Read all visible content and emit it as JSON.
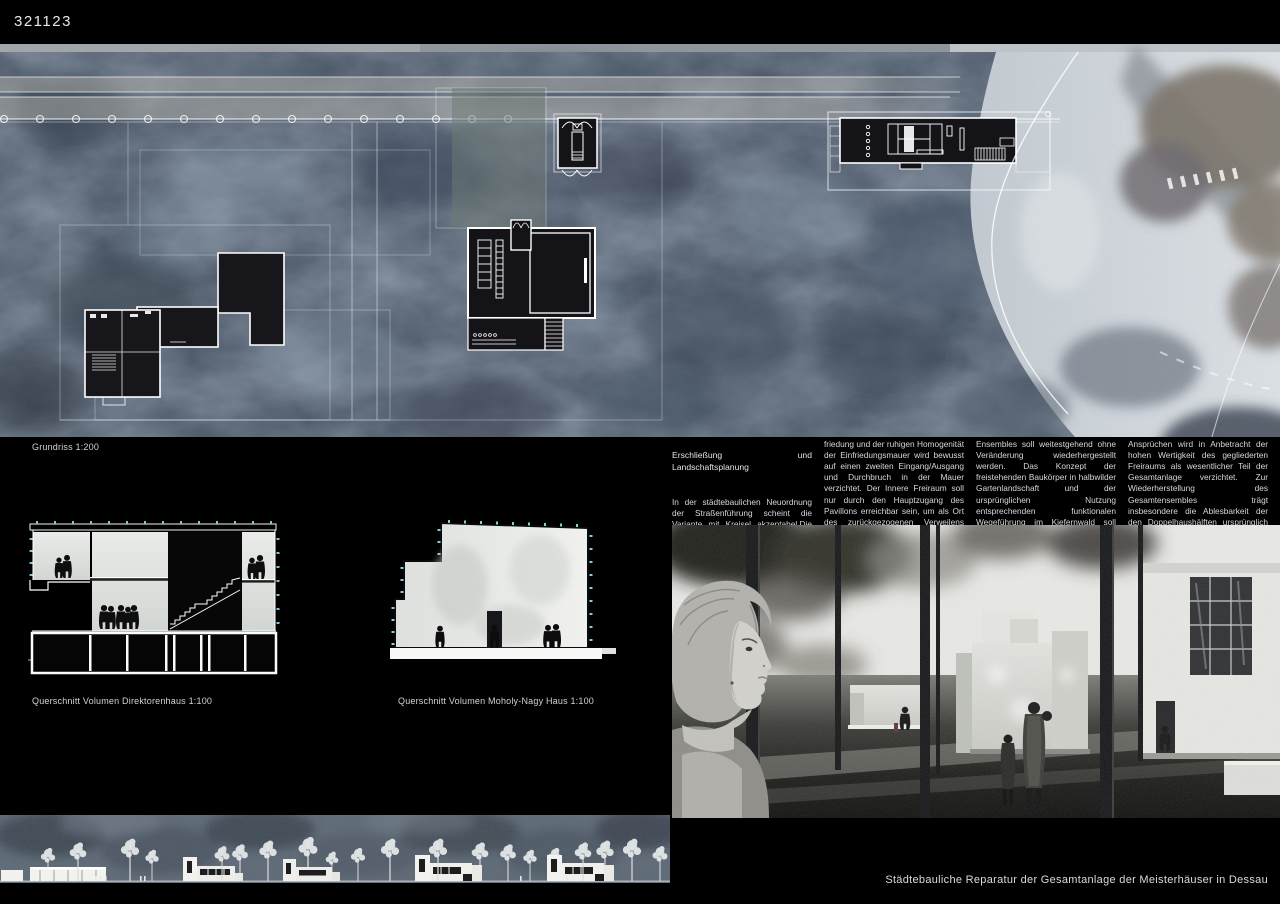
{
  "panel": {
    "code": "321123",
    "caption": "Städtebauliche Reparatur der Gesamtanlage der Meisterhäuser in Dessau"
  },
  "site_plan": {
    "label": "Grundriss 1:200"
  },
  "sections": [
    {
      "label": "Querschnitt Volumen Direktorenhaus 1:100"
    },
    {
      "label": "Querschnitt Volumen Moholy-Nagy Haus 1:100"
    }
  ],
  "description": {
    "heading": "Erschließung und Landschaftsplanung",
    "columns": [
      "In der städtebaulichen Neuordnung der Straßenführung scheint die Variante mit Kreisel akzeptabel.Die fußläufige Erschließung erfolgt von der Gropiusallee oder der Ziebigker Straße kommend über die Ebertallee zum Pavillon. Zugunsten des beruhigten Freiraumes hinter der Grundstücksein-",
      "friedung und der ruhigen Homogenität der Einfriedungsmauer wird bewusst auf einen zweiten Eingang/Ausgang und Durchbruch in der Mauer verzichtet. Der Innere Freiraum soll nur durch den Hauptzugang des Pavillons erreichbar sein, um als Ort des zurückgezogenen Verweilens erhalten zu bleiben.\nDie ursprüngliche Wegeführung innerhalb des",
      "Ensembles soll weitestgehend ohne Veränderung wiederhergestellt werden. Das Konzept der freistehenden Baukörper in halbwilder Gartenlandschaft und der ursprünglichen Nutzung entsprechenden funktionalen Wegeführung im Kiefernwald soll erhalten und gestärkt werden. Auf eine Änderung oder Neugliederung der Wegeführung im Sinne einer funktionellen Optimierung nach heutigen",
      "Ansprüchen wird in Anbetracht der hohen Wertigkeit des gegliederten Freiraums als wesentlicher Teil der Gesamtanlage verzichtet. Zur Wiederherstellung des Gesamtensembles trägt insbesondere die Ablesbarkeit der den Doppelhaushälften ursprünglich zugeordneten Freiflächen bei. Diese können teilweise als Aufenthalts- und Verteilerflächen für Besucher genutzt werden."
    ]
  },
  "colors": {
    "background": "#000000",
    "plan_base": "#475465",
    "plan_light": "#d4d9dd",
    "accent_cyan": "#8fd8e8",
    "text": "#d8d8d8"
  }
}
